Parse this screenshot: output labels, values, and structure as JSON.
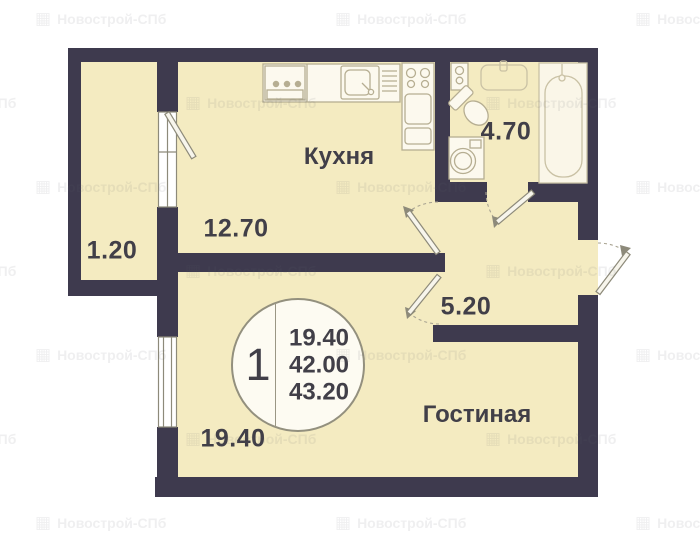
{
  "watermark": {
    "text": "Новострой-СПб"
  },
  "badge": {
    "rooms_count": "1",
    "values": [
      "19.40",
      "42.00",
      "43.20"
    ]
  },
  "rooms": {
    "kitchen": {
      "label": "Кухня",
      "area": "12.70"
    },
    "living": {
      "label": "Гостиная",
      "area": "19.40"
    },
    "bathroom": {
      "area": "4.70"
    },
    "hallway": {
      "area": "5.20"
    },
    "balcony": {
      "area": "1.20"
    }
  },
  "colors": {
    "floor_fill": "#f4ebc1",
    "wall": "#3e3a4e",
    "text": "#413f48",
    "fixture_stroke": "#b6ae92",
    "door_stroke": "#8d8a7a"
  }
}
